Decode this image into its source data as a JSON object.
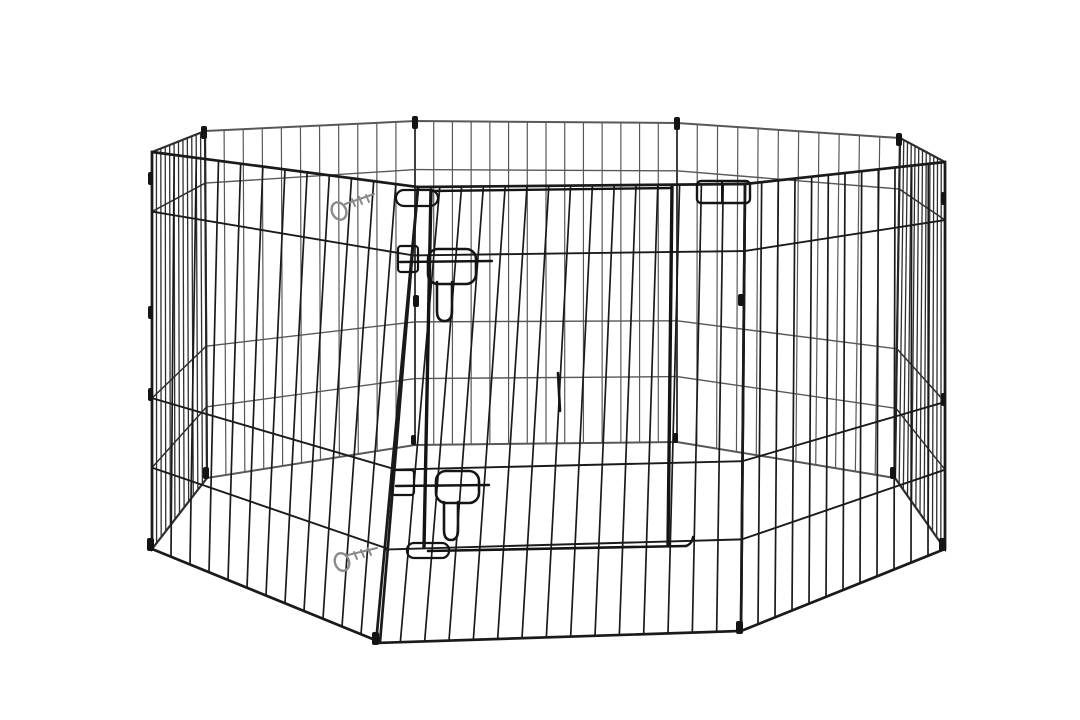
{
  "scene": {
    "background_color": "#ffffff",
    "product": {
      "type": "pet exercise playpen",
      "description": "Black metal wire 8-panel foldable pet exercise pen with a latching sliding door, shown empty at a three-quarter front angle on a seamless white background",
      "panel_count": 8,
      "wire_color": "#1a1a1a",
      "hardware_color": "#8a8a8a",
      "features": [
        "sliding front door",
        "two safety slide latches",
        "bottom slide rod",
        "two silver snap clips",
        "panel hinge connectors"
      ]
    }
  },
  "figure": {
    "canvas": {
      "w": 1080,
      "h": 720
    },
    "rail_fracs": [
      0.15,
      0.62,
      0.795
    ],
    "styles": {
      "far": {
        "color": "#3c3c3c",
        "frame": 2.0,
        "wire": 1.2,
        "opacity": 0.85
      },
      "side": {
        "color": "#242424",
        "frame": 2.2,
        "wire": 1.3,
        "opacity": 0.95
      },
      "near": {
        "color": "#1a1a1a",
        "frame": 2.7,
        "wire": 1.7,
        "opacity": 1
      },
      "ink": "#141414",
      "metal": "#8a8a8a"
    },
    "panels": [
      {
        "name": "back-center",
        "cls": "far",
        "wires": 14,
        "corners": [
          [
            415,
            121
          ],
          [
            677,
            123
          ],
          [
            677,
            442
          ],
          [
            415,
            445
          ]
        ]
      },
      {
        "name": "back-left",
        "cls": "far",
        "wires": 11,
        "corners": [
          [
            205,
            131
          ],
          [
            415,
            121
          ],
          [
            415,
            445
          ],
          [
            207,
            478
          ]
        ]
      },
      {
        "name": "back-right",
        "cls": "far",
        "wires": 11,
        "corners": [
          [
            677,
            123
          ],
          [
            900,
            138
          ],
          [
            895,
            478
          ],
          [
            677,
            442
          ]
        ]
      },
      {
        "name": "side-left",
        "cls": "side",
        "wires": 12,
        "corners": [
          [
            152,
            152
          ],
          [
            205,
            131
          ],
          [
            207,
            478
          ],
          [
            152,
            549
          ]
        ]
      },
      {
        "name": "side-right",
        "cls": "side",
        "wires": 12,
        "corners": [
          [
            900,
            138
          ],
          [
            945,
            162
          ],
          [
            945,
            549
          ],
          [
            895,
            478
          ]
        ]
      },
      {
        "name": "front-left",
        "cls": "near",
        "wires": 12,
        "corners": [
          [
            152,
            152
          ],
          [
            418,
            187
          ],
          [
            380,
            642
          ],
          [
            152,
            549
          ]
        ]
      },
      {
        "name": "front-right",
        "cls": "near",
        "wires": 12,
        "corners": [
          [
            745,
            184
          ],
          [
            945,
            162
          ],
          [
            945,
            549
          ],
          [
            741,
            631
          ]
        ]
      },
      {
        "name": "front-center",
        "cls": "near",
        "wires": 15,
        "corners": [
          [
            418,
            187
          ],
          [
            745,
            184
          ],
          [
            741,
            631
          ],
          [
            376,
            643
          ]
        ]
      }
    ],
    "details": [
      {
        "name": "door-post-left",
        "type": "line",
        "x1": 431,
        "y1": 190,
        "x2": 424,
        "y2": 547,
        "w": 3.4
      },
      {
        "name": "door-post-right",
        "type": "line",
        "x1": 672,
        "y1": 187,
        "x2": 668,
        "y2": 545,
        "w": 3.4
      },
      {
        "name": "door-top-rail",
        "type": "line",
        "x1": 431,
        "y1": 191,
        "x2": 672,
        "y2": 188,
        "w": 2.4
      },
      {
        "name": "door-top-sleeve",
        "type": "rrect",
        "x": 396,
        "y": 190,
        "wd": 42,
        "h": 16,
        "r": 8,
        "w": 2.2
      },
      {
        "name": "door-top-right-keeper",
        "type": "rrect",
        "x": 697,
        "y": 181,
        "wd": 53,
        "h": 22,
        "r": 4,
        "w": 2.4
      },
      {
        "name": "door-keeper-divider",
        "type": "line",
        "x1": 722,
        "y1": 182,
        "x2": 722,
        "y2": 202,
        "w": 2.0
      },
      {
        "name": "upper-latch-bracket",
        "type": "rrect",
        "x": 398,
        "y": 246,
        "wd": 20,
        "h": 26,
        "r": 3,
        "w": 2.2
      },
      {
        "name": "upper-latch-bar",
        "type": "line",
        "x1": 400,
        "y1": 262,
        "x2": 492,
        "y2": 261,
        "w": 2.4
      },
      {
        "name": "upper-latch-plate",
        "type": "rrect",
        "x": 428,
        "y": 249,
        "wd": 48,
        "h": 35,
        "r": 10,
        "w": 2.6
      },
      {
        "name": "upper-latch-slider",
        "type": "path",
        "d": "M437,282 L437,311 Q437,321 444.5,321 Q452,321 452,311 L452,282",
        "w": 2.6
      },
      {
        "name": "lower-latch-bracket",
        "type": "rrect",
        "x": 392,
        "y": 470,
        "wd": 22,
        "h": 25,
        "r": 3,
        "w": 2.2
      },
      {
        "name": "lower-latch-bar",
        "type": "line",
        "x1": 396,
        "y1": 486,
        "x2": 489,
        "y2": 485,
        "w": 2.4
      },
      {
        "name": "lower-latch-plate",
        "type": "rrect",
        "x": 436,
        "y": 471,
        "wd": 43,
        "h": 32,
        "r": 10,
        "w": 2.6
      },
      {
        "name": "lower-latch-slider",
        "type": "path",
        "d": "M444,502 L444,530 Q444,540 451,540 Q458,540 458,530 L458,502",
        "w": 2.6
      },
      {
        "name": "door-bottom-sleeve",
        "type": "rrect",
        "x": 407,
        "y": 543,
        "wd": 42,
        "h": 15,
        "r": 7,
        "w": 2.2
      },
      {
        "name": "door-bottom-rod",
        "type": "line",
        "x1": 428,
        "y1": 551,
        "x2": 686,
        "y2": 546,
        "w": 2.6
      },
      {
        "name": "door-rod-hook",
        "type": "path",
        "d": "M686,546 q6,-2 7,-9",
        "w": 2.4
      },
      {
        "name": "wire-splice",
        "type": "line",
        "x1": 558,
        "y1": 373,
        "x2": 560,
        "y2": 411,
        "w": 2.6
      },
      {
        "name": "snap-clip-upper-ring",
        "type": "ellipse",
        "cx": 339,
        "cy": 211,
        "rx": 7,
        "ry": 9,
        "rot": -25,
        "w": 2.4,
        "c": "#8a8a8a"
      },
      {
        "name": "snap-clip-upper-arm",
        "type": "path",
        "d": "M345,204 L374,194 M352,199 l3,7 M359,197 l3,7 M366,195 l3,7",
        "w": 2.0,
        "c": "#8a8a8a"
      },
      {
        "name": "snap-clip-lower-ring",
        "type": "ellipse",
        "cx": 342,
        "cy": 562,
        "rx": 7,
        "ry": 9,
        "rot": -20,
        "w": 2.4,
        "c": "#8a8a8a"
      },
      {
        "name": "snap-clip-lower-arm",
        "type": "path",
        "d": "M348,555 L377,548 M354,552 l3,7 M361,550 l3,7 M368,548 l3,7",
        "w": 2.0,
        "c": "#8a8a8a"
      },
      {
        "name": "hinge-mark",
        "type": "mark",
        "x": 201,
        "y": 126,
        "wd": 6,
        "h": 13
      },
      {
        "name": "hinge-mark",
        "type": "mark",
        "x": 412,
        "y": 116,
        "wd": 6,
        "h": 13
      },
      {
        "name": "hinge-mark",
        "type": "mark",
        "x": 674,
        "y": 117,
        "wd": 6,
        "h": 13
      },
      {
        "name": "hinge-mark",
        "type": "mark",
        "x": 896,
        "y": 133,
        "wd": 6,
        "h": 13
      },
      {
        "name": "hinge-mark",
        "type": "mark",
        "x": 148,
        "y": 172,
        "wd": 5,
        "h": 13
      },
      {
        "name": "hinge-mark",
        "type": "mark",
        "x": 148,
        "y": 306,
        "wd": 5,
        "h": 13
      },
      {
        "name": "hinge-mark",
        "type": "mark",
        "x": 148,
        "y": 388,
        "wd": 5,
        "h": 13
      },
      {
        "name": "hinge-mark",
        "type": "mark",
        "x": 941,
        "y": 192,
        "wd": 5,
        "h": 13
      },
      {
        "name": "hinge-mark",
        "type": "mark",
        "x": 941,
        "y": 393,
        "wd": 5,
        "h": 13
      },
      {
        "name": "hinge-mark",
        "type": "mark",
        "x": 413,
        "y": 295,
        "wd": 6,
        "h": 12
      },
      {
        "name": "hinge-mark",
        "type": "mark",
        "x": 738,
        "y": 294,
        "wd": 6,
        "h": 12
      },
      {
        "name": "foot-cap",
        "type": "mark",
        "x": 147,
        "y": 538,
        "wd": 7,
        "h": 13
      },
      {
        "name": "foot-cap",
        "type": "mark",
        "x": 939,
        "y": 538,
        "wd": 7,
        "h": 13
      },
      {
        "name": "foot-cap",
        "type": "mark",
        "x": 372,
        "y": 632,
        "wd": 7,
        "h": 13
      },
      {
        "name": "foot-cap",
        "type": "mark",
        "x": 736,
        "y": 621,
        "wd": 7,
        "h": 13
      },
      {
        "name": "foot-cap",
        "type": "mark",
        "x": 203,
        "y": 467,
        "wd": 6,
        "h": 12
      },
      {
        "name": "foot-cap",
        "type": "mark",
        "x": 890,
        "y": 467,
        "wd": 6,
        "h": 12
      },
      {
        "name": "foot-cap",
        "type": "mark",
        "x": 411,
        "y": 435,
        "wd": 5,
        "h": 10
      },
      {
        "name": "foot-cap",
        "type": "mark",
        "x": 673,
        "y": 433,
        "wd": 5,
        "h": 10
      }
    ]
  }
}
